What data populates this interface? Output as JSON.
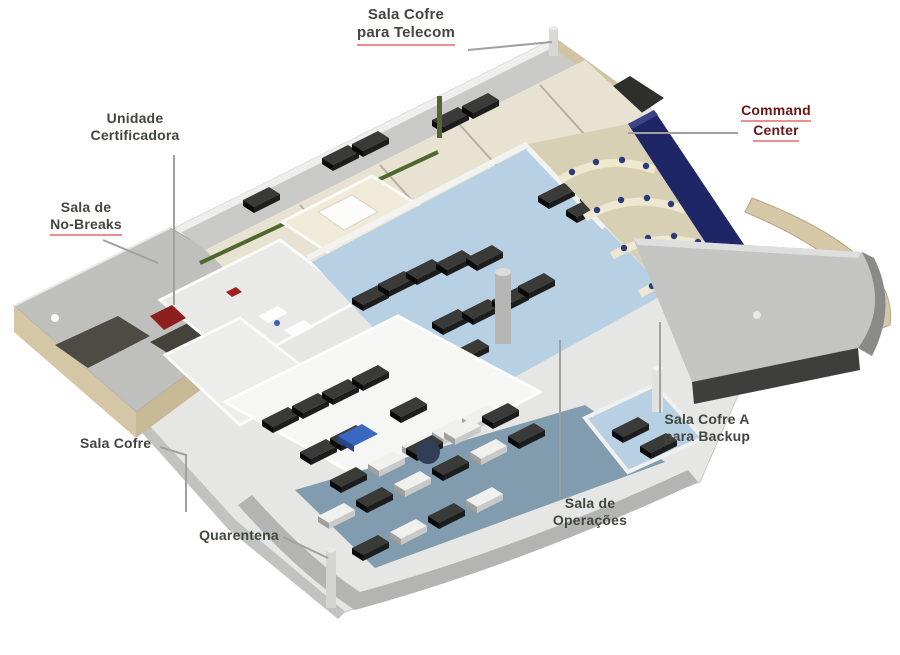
{
  "figure": {
    "type": "isometric-floorplan",
    "subject": "data center facility cutaway rendering"
  },
  "labels": {
    "sala_cofre_telecom": {
      "line1": "Sala Cofre",
      "line2": "para Telecom"
    },
    "unidade_certificadora": {
      "line1": "Unidade",
      "line2": "Certificadora"
    },
    "sala_no_breaks": {
      "line1": "Sala de",
      "line2": "No-Breaks"
    },
    "command_center": {
      "line1": "Command",
      "line2": "Center"
    },
    "sala_cofre_a": {
      "line1": "Sala Cofre A",
      "line2": "para Backup"
    },
    "sala_operacoes": {
      "line1": "Sala de",
      "line2": "Operações"
    },
    "sala_cofre": {
      "line1": "Sala Cofre"
    },
    "quarentena": {
      "line1": "Quarentena"
    }
  },
  "colors": {
    "background": "#ffffff",
    "video_wall": "#1f2666",
    "server_room_floor": "#b7d0e3",
    "quarantine_floor": "#819cae",
    "roof_gray": "#c4c4c2",
    "outer_wall_beige": "#d5c6a5",
    "rack_black": "#161616",
    "accent_red": "#8e1f1f",
    "cable_tray_green": "#4e682e",
    "label_text": "#41463f",
    "label_red_text": "#6a1515",
    "underline_red": "#e89090",
    "leader_line": "#a0a0a0"
  }
}
